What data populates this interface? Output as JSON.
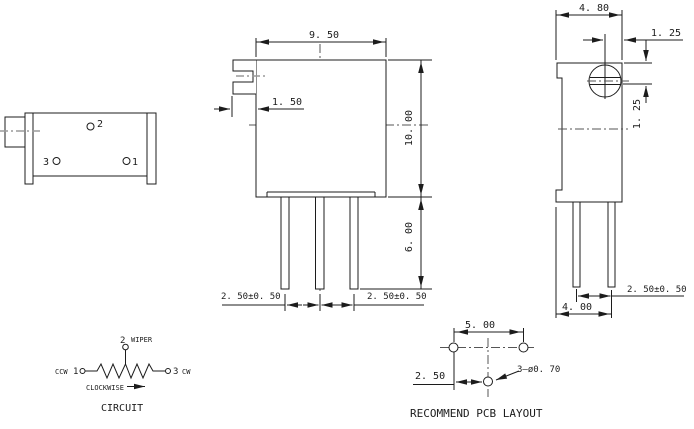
{
  "front": {
    "width": "9. 50",
    "screw_offset": "1. 50",
    "height": "10. 00",
    "pin_length": "6. 00",
    "pitch_left": "2. 50±0. 50",
    "pitch_right": "2. 50±0. 50"
  },
  "left": {
    "pin1": "1",
    "pin2": "2",
    "pin3": "3"
  },
  "right": {
    "depth": "4. 80",
    "screw_x": "1. 25",
    "screw_y": "1. 25",
    "pin_span": "4. 00",
    "pin_pitch": "2. 50±0. 50"
  },
  "circuit": {
    "pin2": "2",
    "wiper": "WIPER",
    "ccw": "CCW",
    "pin1": "1",
    "pin3": "3",
    "cw": "CW",
    "rotation": "CLOCKWISE",
    "caption": "CIRCUIT"
  },
  "pcb": {
    "pitch": "5. 00",
    "offset": "2. 50",
    "holes": "3—ø0. 70",
    "caption": "RECOMMEND PCB LAYOUT"
  },
  "colors": {
    "line": "#1c1c1c",
    "centerline": "#9a9a9a",
    "background": "#ffffff"
  }
}
